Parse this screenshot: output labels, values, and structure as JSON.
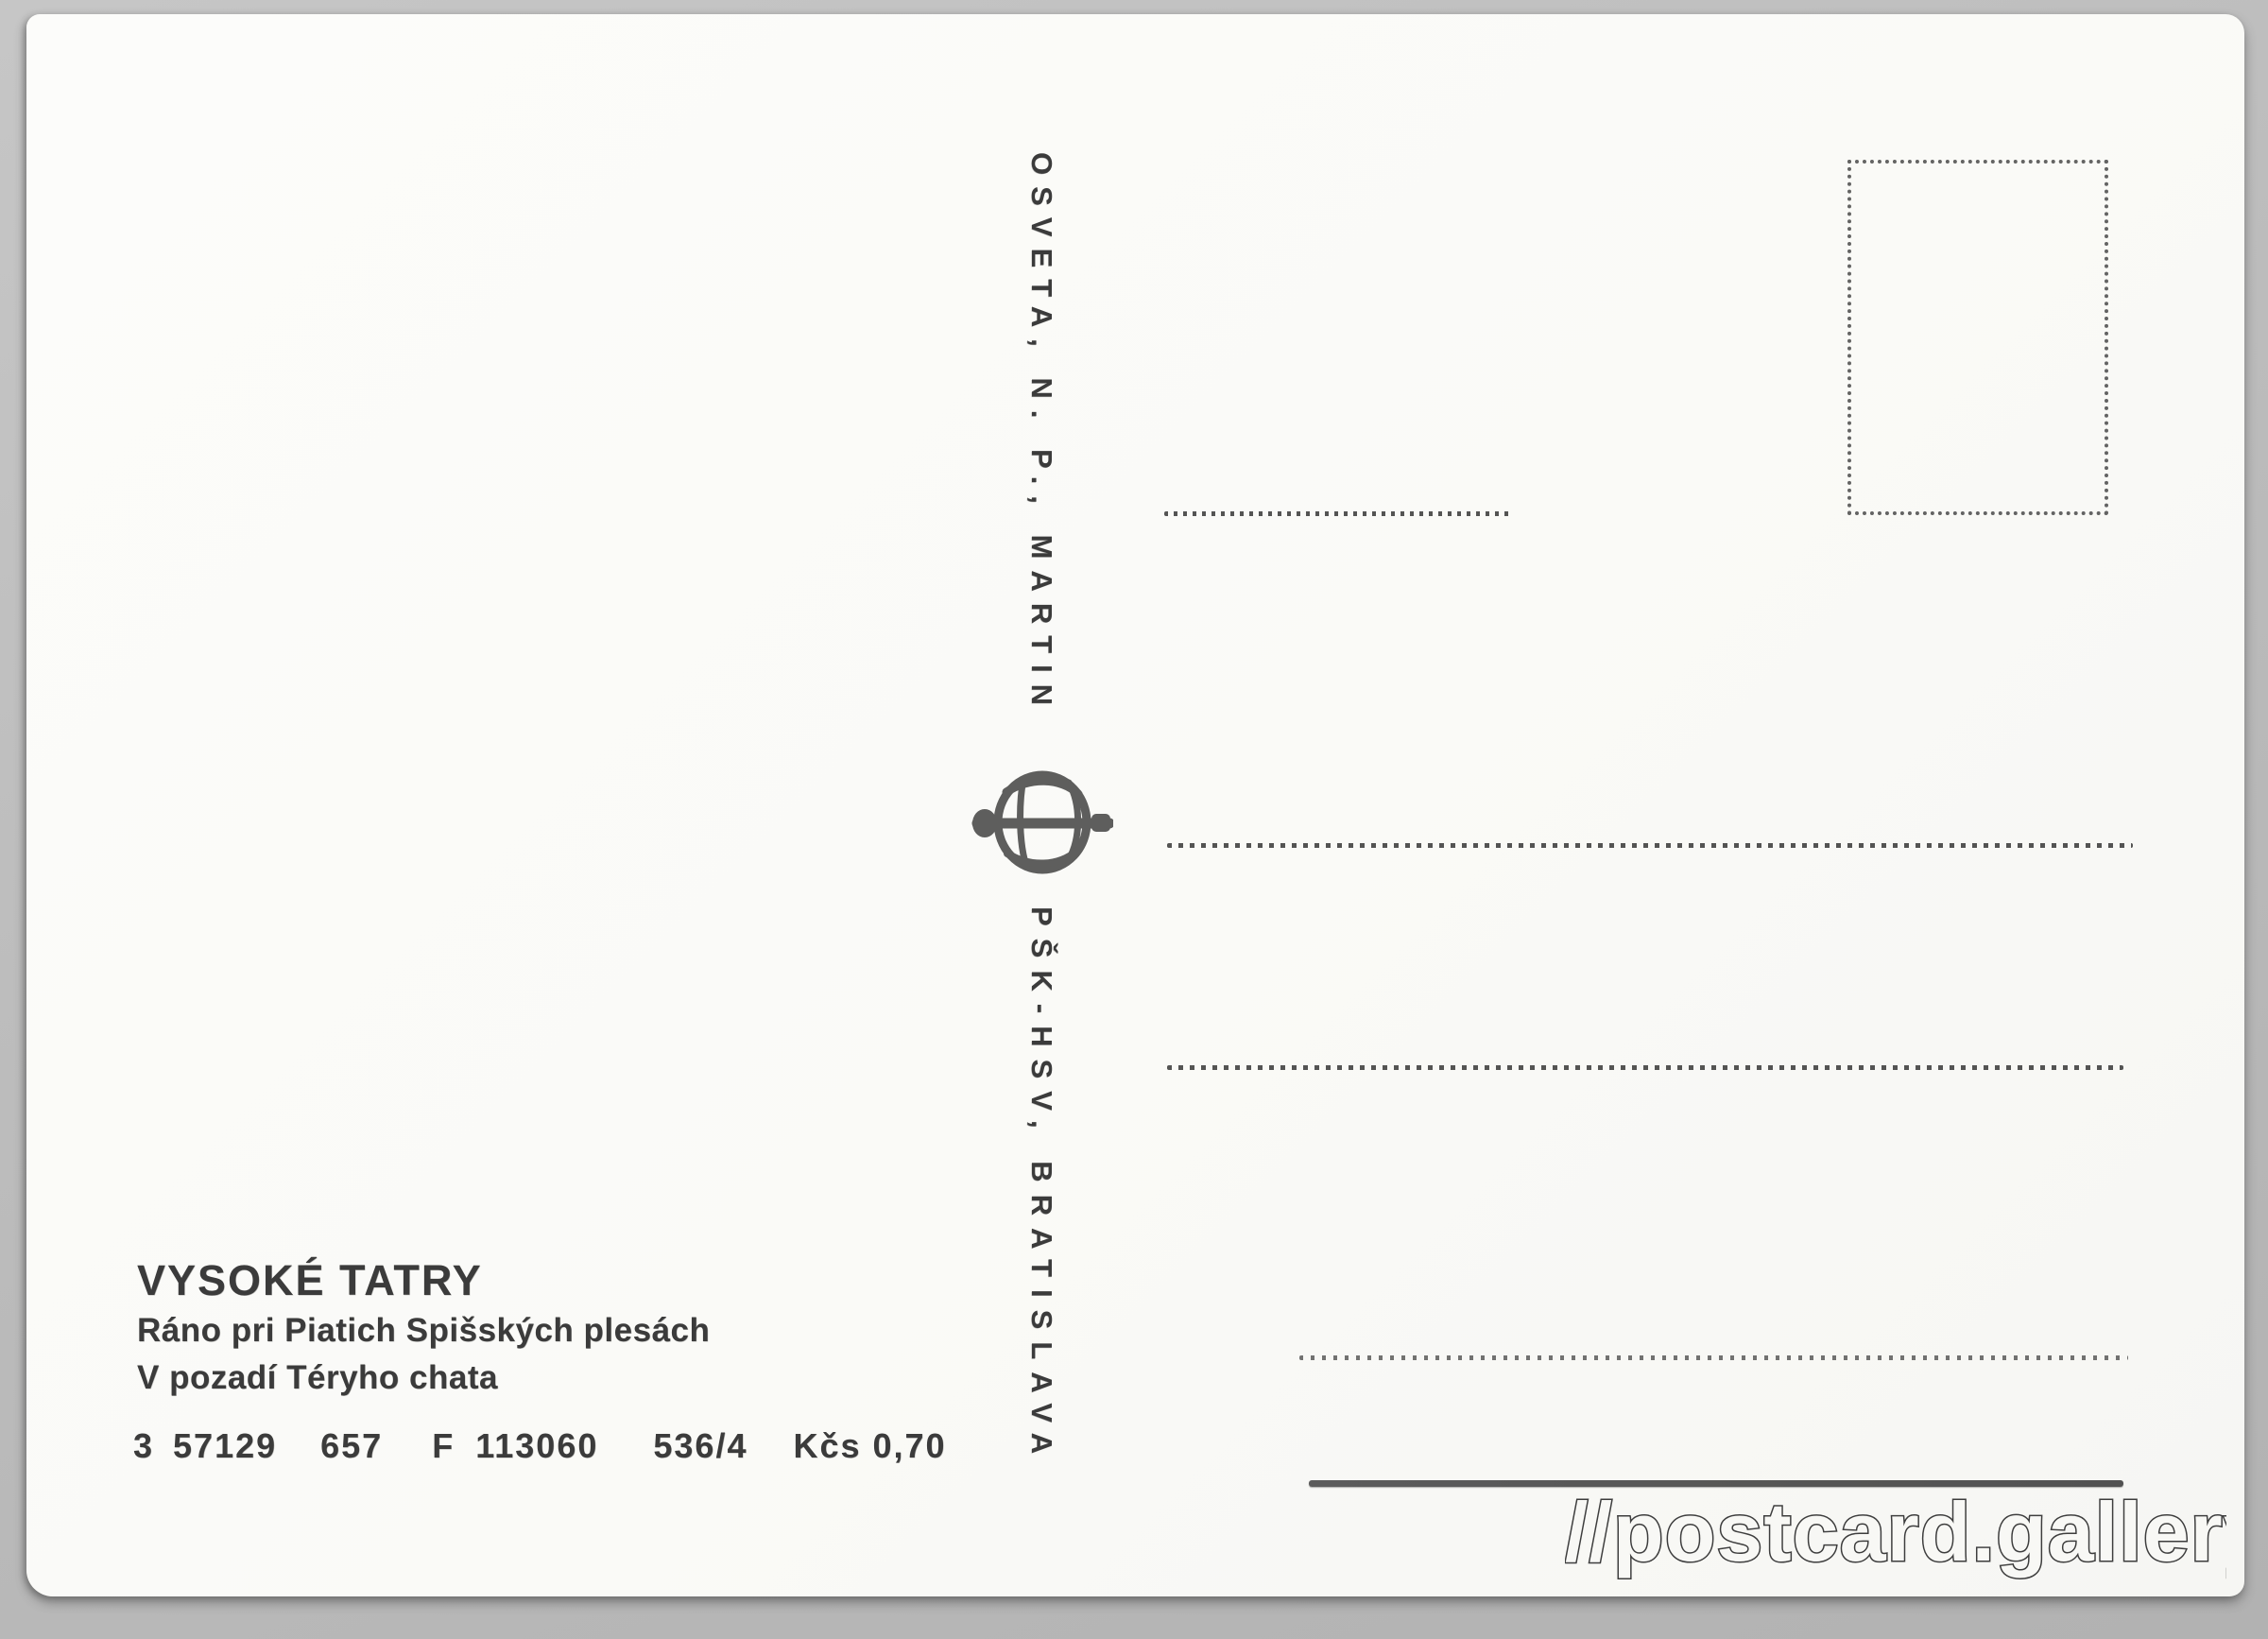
{
  "scan": {
    "background_color": "#bdbdbd",
    "paper_color": "#fbfbf9",
    "ink_color": "#3b3b3b"
  },
  "publisher": {
    "imprint_top": "OSVETA, N. P., MARTIN",
    "imprint_bottom": "PŠK-HSV, BRATISLAVA",
    "logo_icon": "osveta-globe-book-logo"
  },
  "caption": {
    "title": "VYSOKÉ TATRY",
    "line1": "Ráno pri Piatich Spišských plesách",
    "line2": "V pozadí Téryho chata"
  },
  "catalog": {
    "tokens": [
      "3",
      "57129",
      "657",
      "F",
      "113060"
    ],
    "series": "536/4",
    "price": "Kčs 0,70"
  },
  "watermark": {
    "text": "//postcard.gallery"
  }
}
